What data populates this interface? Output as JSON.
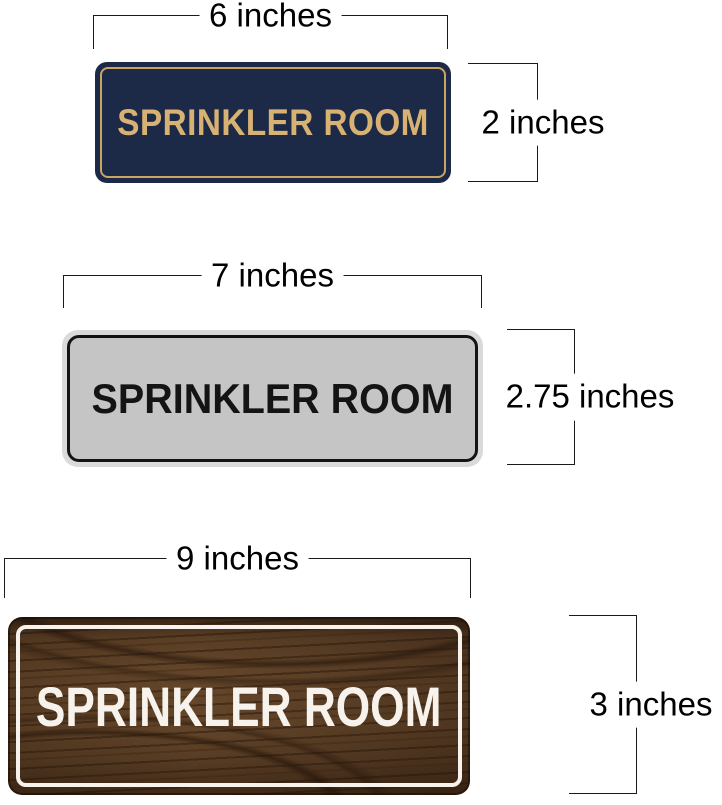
{
  "title": "Sprinkler Room sign size comparison diagram",
  "annotation": {
    "line_color": "#1a1a1a",
    "text_color": "#000000"
  },
  "sections": [
    {
      "name": "navy-gold-sign",
      "sign_text": "SPRINKLER ROOM",
      "width_label": "6 inches",
      "height_label": "2 inches",
      "colors": {
        "plate": "#1d2a47",
        "frame": "#c9a463",
        "text": "#d8b273"
      }
    },
    {
      "name": "silver-sign",
      "sign_text": "SPRINKLER ROOM",
      "width_label": "7 inches",
      "height_label": "2.75 inches",
      "colors": {
        "plate": "#c5c5c5",
        "rim": "#dadada",
        "frame": "#141414",
        "text": "#141414"
      }
    },
    {
      "name": "walnut-wood-sign",
      "sign_text": "SPRINKLER ROOM",
      "width_label": "9 inches",
      "height_label": "3 inches",
      "colors": {
        "plate": "#5d4128",
        "frame": "#f7f3ec",
        "text": "#f7f3ec"
      }
    }
  ]
}
